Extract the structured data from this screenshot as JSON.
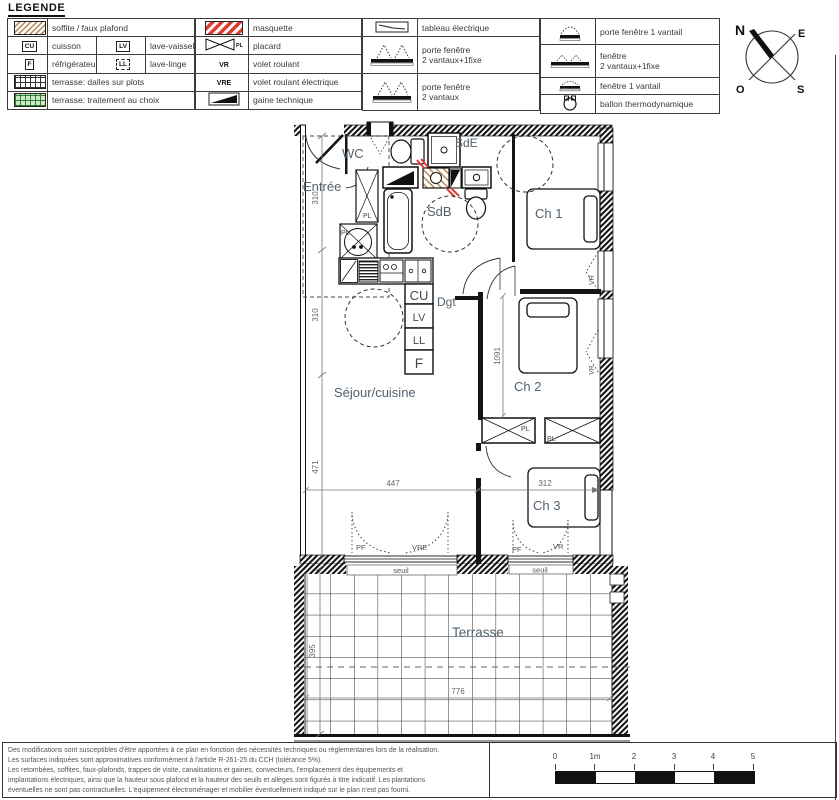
{
  "legend": {
    "title": "LEGENDE",
    "group1": {
      "row1_label": "soffite / faux plafond",
      "row2_key1": "CU",
      "row2_label1": "cuisson",
      "row2_key2": "LV",
      "row2_label2": "lave-vaisselle",
      "row3_key1": "F",
      "row3_label1": "réfrigérateur",
      "row3_key2": "LL",
      "row3_label2": "lave-linge",
      "row4_label": "terrasse: dalles sur plots",
      "row5_label": "terrasse: traitement au choix"
    },
    "group2": {
      "row1_label": "masquette",
      "row2_key": "PL",
      "row2_label": "placard",
      "row3_key": "VR",
      "row3_label": "volet roulant",
      "row4_key": "VRE",
      "row4_label": "volet roulant électrique",
      "row5_label": "gaine technique"
    },
    "group3": {
      "row1_label": "tableau électrique",
      "row2_line1": "porte fenêtre",
      "row2_line2": "2 vantaux+1fixe",
      "row3_line1": "porte fenêtre",
      "row3_line2": "2 vantaux"
    },
    "group4": {
      "row1_label": "porte fenêtre 1 vantail",
      "row2_line1": "fenêtre",
      "row2_line2": "2 vantaux+1fixe",
      "row3_label": "fenêtre 1 vantail",
      "row4_label": "ballon thermodynamique"
    }
  },
  "compass": {
    "north": "N",
    "east": "E",
    "west": "O",
    "south": "S"
  },
  "plan": {
    "rooms": {
      "entree": "Entrée",
      "wc": "WC",
      "sde": "SdE",
      "sdb": "SdB",
      "ch1": "Ch 1",
      "dgt": "Dgt",
      "sejour": "Séjour/cuisine",
      "ch2": "Ch 2",
      "ch3": "Ch 3",
      "terrasse": "Terrasse"
    },
    "appliances": {
      "cu": "CU",
      "lv": "LV",
      "ll": "LL",
      "f": "F"
    },
    "tags": {
      "pl": "PL",
      "vr": "VR",
      "vre": "VRE",
      "pf": "PF",
      "seuil": "seuil"
    },
    "dims": {
      "entree_height": "310",
      "kitchen_height": "310",
      "sejour_height": "471",
      "sejour_width": "447",
      "ch2_height": "1091",
      "ch3_width": "312",
      "terrasse_height": "395",
      "terrasse_width": "776"
    }
  },
  "footer": {
    "lines": [
      "Des modifications sont susceptibles d'être apportées à ce plan en fonction des nécessités techniques ou règlementaires lors de la réalisation.",
      "Les surfaces indiquées sont approximatives conformément à l'article R-261-25 du CCH (tolérance 5%).",
      "Les retombées, soffites, faux-plafonds, trappes de visite, canalisations et gaines, convecteurs, l'emplacement des équipements et",
      "implantations électriques, ainsi que la hauteur sous plafond et la hauteur des seuils et allèges sont figurés à titre indicatif. Les plantations",
      "éventuelles ne sont pas contractuelles. L'équipement électroménager et mobilier éventuellement indiqué sur le plan n'est pas fourni."
    ],
    "scale_ticks": [
      "0",
      "1m",
      "2",
      "3",
      "4",
      "5"
    ]
  },
  "colors": {
    "room_label": "#51626f",
    "soffite_hatch": "#b5854f",
    "masquette_red": "#e03c31",
    "terrace_green": "#2e7d32",
    "dim_text": "#666666"
  }
}
